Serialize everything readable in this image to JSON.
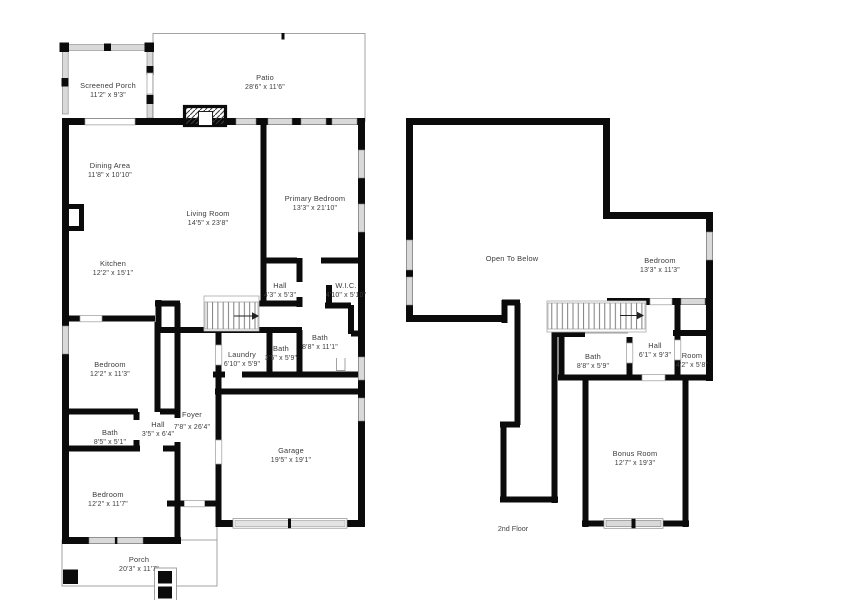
{
  "meta": {
    "type": "real-estate floor plan, two stacked plans (1st floor left, 2nd floor right)",
    "colors": {
      "wall": "#0b0b0b",
      "window_fill": "#d9d9d9",
      "thin_line": "#9a9a9a",
      "label_text": "#3b3b3b",
      "background": "#ffffff"
    }
  },
  "f1": {
    "screened_porch": {
      "name": "Screened Porch",
      "dims": "11'2\" x 9'3\""
    },
    "patio": {
      "name": "Patio",
      "dims": "28'6\" x 11'6\""
    },
    "dining": {
      "name": "Dining Area",
      "dims": "11'8\" x 10'10\""
    },
    "living": {
      "name": "Living Room",
      "dims": "14'5\" x 23'8\""
    },
    "primary": {
      "name": "Primary Bedroom",
      "dims": "13'3\" x 21'10\""
    },
    "kitchen": {
      "name": "Kitchen",
      "dims": "12'2\" x 15'1\""
    },
    "hall_upper": {
      "name": "Hall",
      "dims": "4'3\" x 5'3\""
    },
    "wic": {
      "name": "W.I.C.",
      "dims": "4'10\" x 5'10\""
    },
    "bath_primary": {
      "name": "Bath",
      "dims": "8'8\" x 11'1\""
    },
    "laundry": {
      "name": "Laundry",
      "dims": "6'10\" x 5'9\""
    },
    "bath_small": {
      "name": "Bath",
      "dims": "3'5\" x 5'9\""
    },
    "bedroom_mid": {
      "name": "Bedroom",
      "dims": "12'2\" x 11'3\""
    },
    "foyer": {
      "name": "Foyer",
      "dims": "7'8\" x 26'4\""
    },
    "hall_lower": {
      "name": "Hall",
      "dims": "3'5\" x 6'4\""
    },
    "bath_hall": {
      "name": "Bath",
      "dims": "8'5\" x 5'1\""
    },
    "bedroom_front": {
      "name": "Bedroom",
      "dims": "12'2\" x 11'7\""
    },
    "garage": {
      "name": "Garage",
      "dims": "19'5\" x 19'1\""
    },
    "porch": {
      "name": "Porch",
      "dims": "20'3\" x 11'7\""
    }
  },
  "f2": {
    "open_below": {
      "name": "Open To Below"
    },
    "bedroom": {
      "name": "Bedroom",
      "dims": "13'3\" x 11'3\""
    },
    "bath": {
      "name": "Bath",
      "dims": "8'8\" x 5'9\""
    },
    "hall": {
      "name": "Hall",
      "dims": "6'1\" x 9'3\""
    },
    "room": {
      "name": "Room",
      "dims": "4'2\" x 5'8\""
    },
    "bonus": {
      "name": "Bonus Room",
      "dims": "12'7\" x 19'3\""
    },
    "caption": "2nd Floor"
  }
}
